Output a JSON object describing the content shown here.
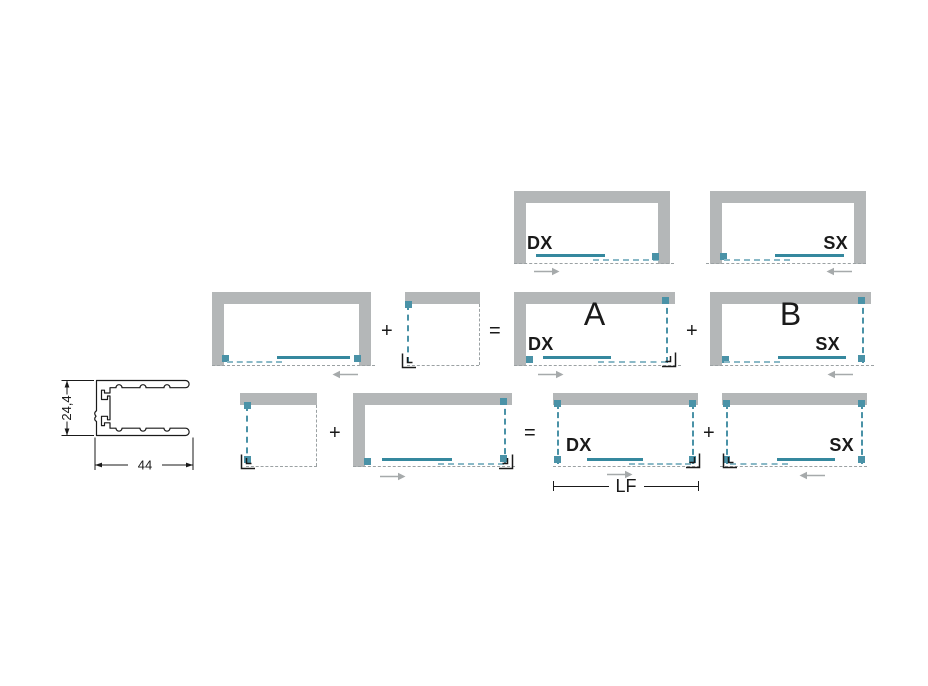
{
  "colors": {
    "wall": "#b4b7b8",
    "door_solid": "#35889e",
    "door_dashed": "#8ab9c7",
    "marker": "#4a92a7",
    "open_edge": "#9ba1a3",
    "arrow": "#a6aaab",
    "text": "#1a1a1a"
  },
  "profile": {
    "height_dim": "24,4",
    "width_dim": "44"
  },
  "operators": {
    "plus": "+",
    "equals": "="
  },
  "rows": {
    "top": {
      "dx": "DX",
      "sx": "SX"
    },
    "middle": {
      "a": "A",
      "a_side": "DX",
      "b": "B",
      "b_side": "SX"
    },
    "bottom": {
      "dx": "DX",
      "sx": "SX",
      "length": "LF"
    }
  },
  "icons": {
    "slide_right": "arrow-right-icon",
    "slide_left": "arrow-left-icon",
    "corner": "corner-bracket-icon"
  }
}
